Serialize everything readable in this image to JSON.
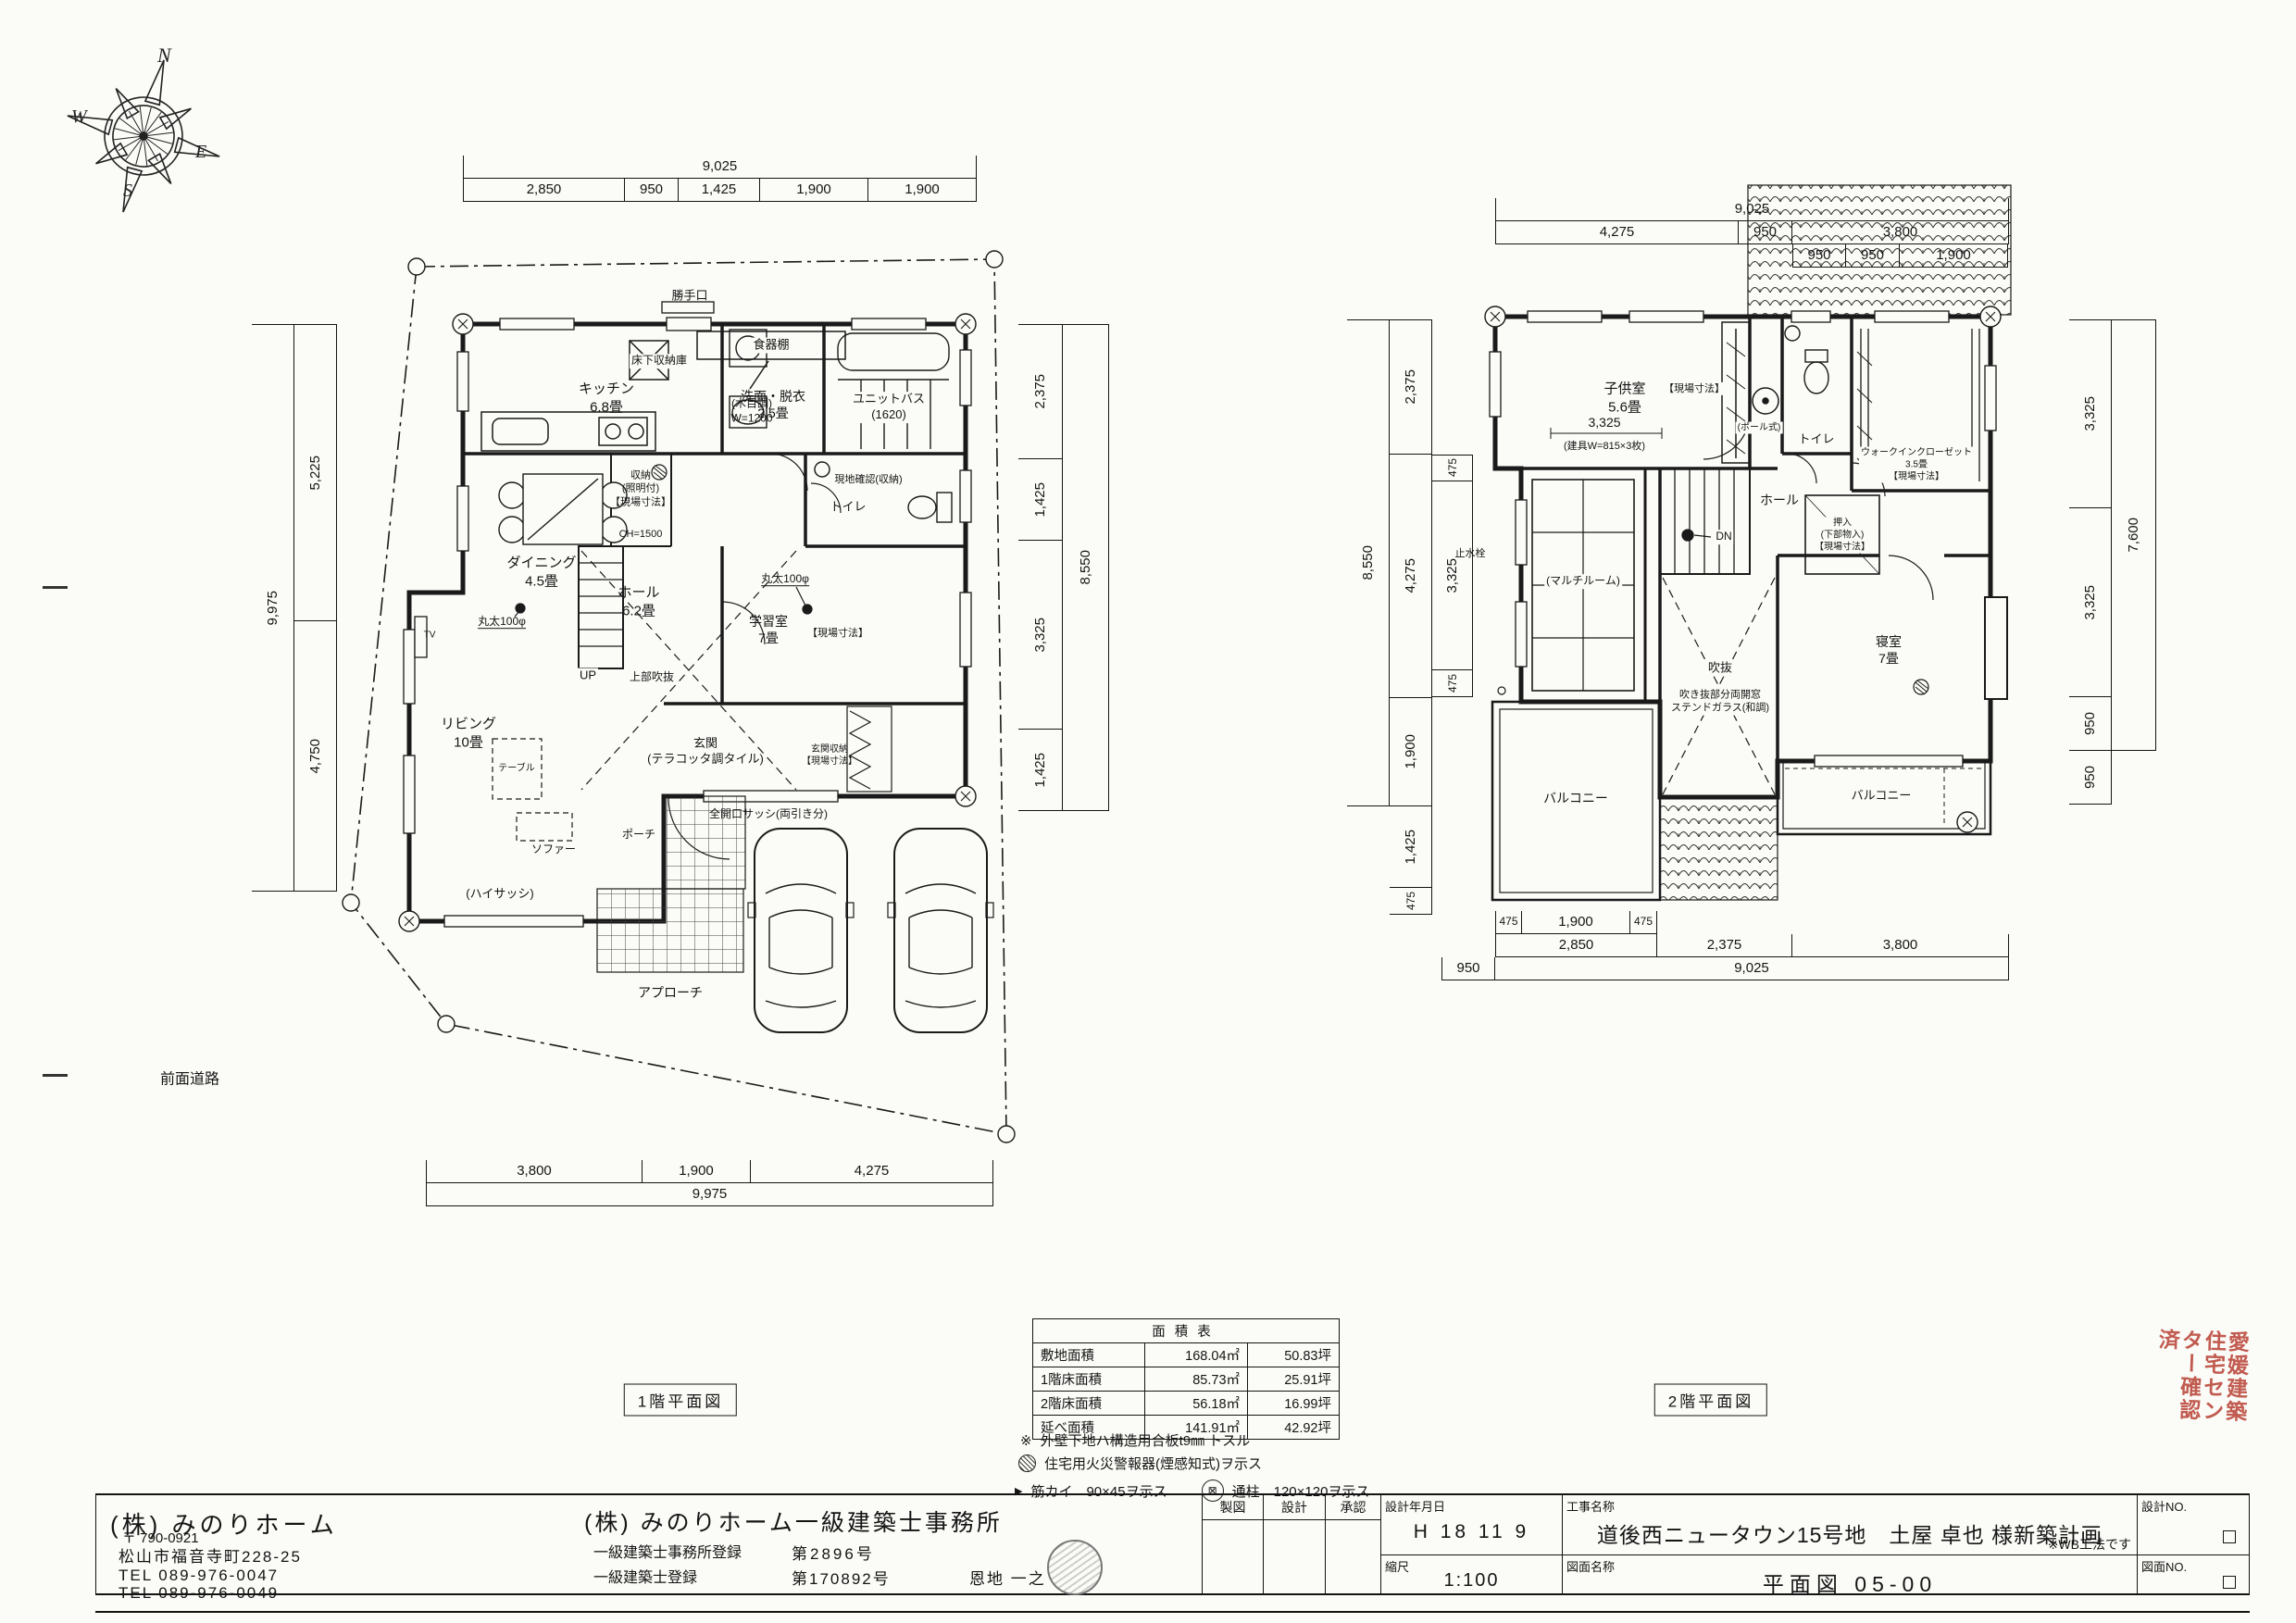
{
  "compass": {
    "n": "N",
    "e": "E",
    "s": "S",
    "w": "W"
  },
  "page": {
    "front_road": "前面道路"
  },
  "floor1": {
    "name": "1階平面図",
    "dims": {
      "top_total": "9,025",
      "top": [
        "2,850",
        "950",
        "1,425",
        "1,900",
        "1,900"
      ],
      "left_total": "9,975",
      "left": [
        "5,225",
        "4,750"
      ],
      "right_total": "8,550",
      "right": [
        "2,375",
        "1,425",
        "3,325",
        "1,425"
      ],
      "bottom": [
        "3,800",
        "1,900",
        "4,275"
      ],
      "bottom_total": "9,975"
    },
    "labels": {
      "katteguchi": "勝手口",
      "dish_shelf": "食器棚",
      "dish_shelf_note": "(木目調)\nW=1200",
      "floor_storage": "床下収納庫",
      "kitchen": "キッチン\n6.8畳",
      "washroom": "洗面・脱衣\n2.5畳",
      "unit_bath": "ユニットバス\n(1620)",
      "storage": "収納\n(照明付)\n【現場寸法】",
      "storage_ch": "CH=1500",
      "site_check": "現地確認(収納)",
      "toilet": "トイレ",
      "dining": "ダイニング\n4.5畳",
      "hall": "ホール\n6.2畳",
      "up": "UP",
      "void_above": "上部吹抜",
      "study": "学習室\n7畳",
      "field_dim": "【現場寸法】",
      "log1": "丸太100φ",
      "log2": "丸太100φ",
      "entrance": "玄関\n(テラコッタ調タイル)",
      "entrance_storage": "玄関収納\n【現場寸法】",
      "full_sash": "全開口サッシ(両引き分)",
      "porch": "ポーチ",
      "living": "リビング\n10畳",
      "table": "テーブル",
      "sofa": "ソファー",
      "high_sash": "(ハイサッシ)",
      "tv": "TV",
      "approach": "アプローチ"
    }
  },
  "floor2": {
    "name": "2階平面図",
    "dims": {
      "top_total": "9,025",
      "top": [
        "4,275",
        "950",
        "3,800"
      ],
      "top_sub": [
        "950",
        "950",
        "1,900"
      ],
      "left_total": "8,550",
      "left": [
        "2,375",
        "4,275",
        "1,900"
      ],
      "left_inner": [
        "475",
        "3,325",
        "475"
      ],
      "left_below": [
        "1,425",
        "475"
      ],
      "right_total": "7,600",
      "right": [
        "3,325",
        "3,325",
        "950"
      ],
      "right_below": "950",
      "bottom_sub": [
        "475",
        "1,900",
        "475"
      ],
      "bottom": [
        "2,850",
        "2,375",
        "3,800"
      ],
      "bottom_left": "950",
      "bottom_total": "9,025"
    },
    "labels": {
      "kids": "子供室\n5.6畳",
      "kids_dim": "3,325",
      "kids_note": "(建具W=815×3枚)",
      "field_dim": "【現場寸法】",
      "pole": "(ポール式)",
      "toilet": "トイレ",
      "wic": "ウォークインクローゼット\n3.5畳\n【現場寸法】",
      "hall": "ホール",
      "oshiire": "押入\n(下部物入)\n【現場寸法】",
      "dn": "DN",
      "multi": "(マルチルーム)",
      "stop_valve": "止水栓",
      "void": "吹抜",
      "void_note": "吹き抜部分両開窓\nステンドガラス(和調)",
      "bedroom": "寝室\n7畳",
      "balcony_l": "バルコニー",
      "balcony_r": "バルコニー"
    }
  },
  "area_table": {
    "title": "面積表",
    "rows": [
      {
        "label": "敷地面積",
        "m2": "168.04㎡",
        "tsubo": "50.83坪"
      },
      {
        "label": "1階床面積",
        "m2": "85.73㎡",
        "tsubo": "25.91坪"
      },
      {
        "label": "2階床面積",
        "m2": "56.18㎡",
        "tsubo": "16.99坪"
      },
      {
        "label": "延べ面積",
        "m2": "141.91㎡",
        "tsubo": "42.92坪"
      }
    ],
    "notes": {
      "n1_mark": "※",
      "n1": "外壁下地ハ構造用合板t9㎜ トスル",
      "n2": "住宅用火災警報器(煙感知式)ヲ示ス",
      "n3_mark": "▶",
      "n3": "筋カイ　90×45ヲ示ス",
      "n4_mark": "⊠",
      "n4": "通柱　120×120ヲ示ス"
    }
  },
  "title_block": {
    "company": "(株) みのりホーム",
    "postal": "〒 790-0921",
    "address": "松山市福音寺町228-25",
    "tel1": "TEL 089-976-0047",
    "tel2": "TEL 089-976-0049",
    "office": "(株) みのりホーム一級建築士事務所",
    "reg1_label": "一級建築士事務所登録",
    "reg1_value": "第2896号",
    "reg2_label": "一級建築士登録",
    "reg2_value": "第170892号",
    "architect": "恩地 一之",
    "col_drafting": "製図",
    "col_design": "設計",
    "col_approval": "承認",
    "date_label": "設計年月日",
    "date_value": "H 18 11 9",
    "project_label": "工事名称",
    "project_value": "道後西ニュータウン15号地　土屋 卓也 様新築計画",
    "wb_note": "※WB工法です",
    "scale_label": "縮尺",
    "scale_value": "1:100",
    "sheet_label": "図面名称",
    "sheet_value": "平面図 05-00",
    "design_no_label": "設計NO.",
    "sheet_no_label": "図面NO."
  },
  "red_seal": "愛媛建築\n住宅セン\nター確認\n済"
}
